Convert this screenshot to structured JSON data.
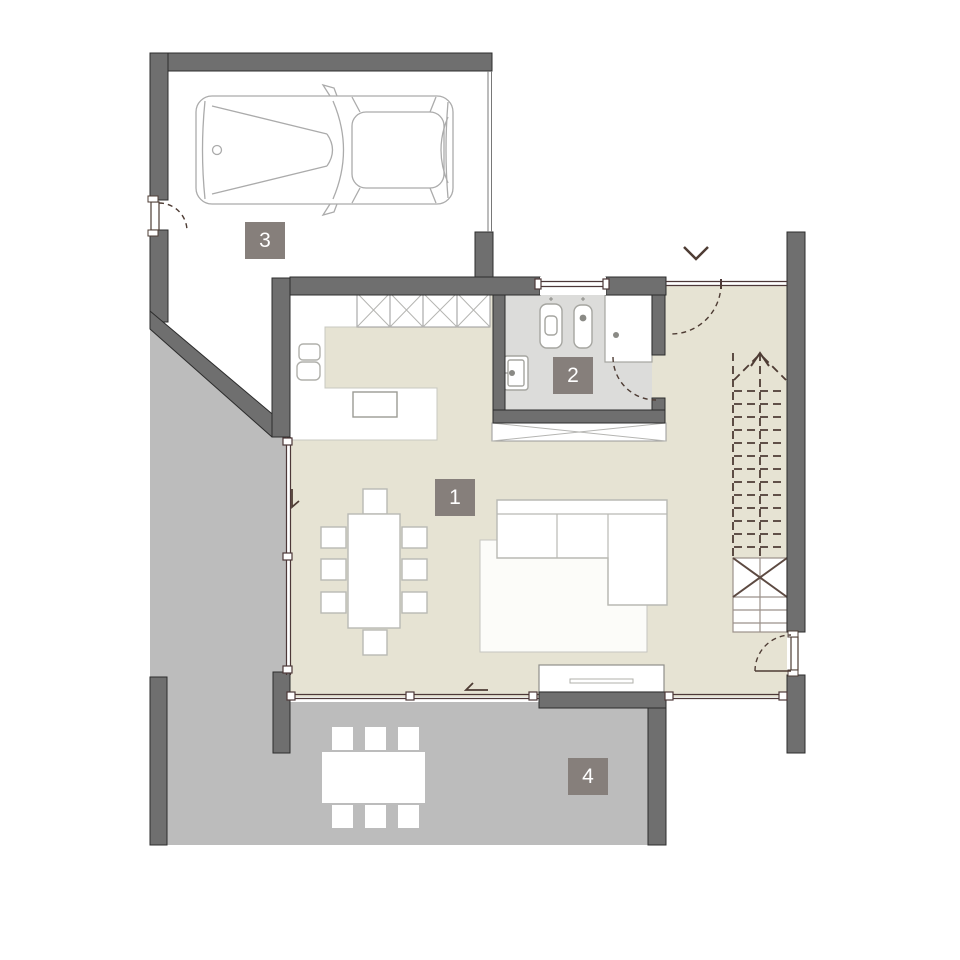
{
  "plan": {
    "type": "architectural-floor-plan",
    "rooms": [
      {
        "id": "living-dining-kitchen",
        "label": "1"
      },
      {
        "id": "bathroom",
        "label": "2"
      },
      {
        "id": "garage",
        "label": "3"
      },
      {
        "id": "terrace",
        "label": "4"
      }
    ],
    "symbols": [
      "car-top-view",
      "staircase-up-dashed",
      "entry-chevron-arrow",
      "door-swing-arc",
      "window-glazing-line",
      "shower",
      "toilet",
      "bidet",
      "washbasin",
      "wardrobe-crossed",
      "kitchen-counter",
      "dining-table-8-chairs",
      "corner-sofa-with-rug",
      "sideboard",
      "terrace-table-6-chairs"
    ],
    "colors": {
      "badge_bg": "#867f7b",
      "badge_text": "#ffffff",
      "wall_fill": "#6f6f6f",
      "wall_stroke": "#2c2c2c",
      "floor_interior": "#e6e3d3",
      "floor_bathroom": "#dcdcda",
      "floor_terrace": "#bcbcbc",
      "door_line": "#4e3c34",
      "furniture_outline": "#b9b9b4",
      "car_outline": "#ababab"
    }
  }
}
